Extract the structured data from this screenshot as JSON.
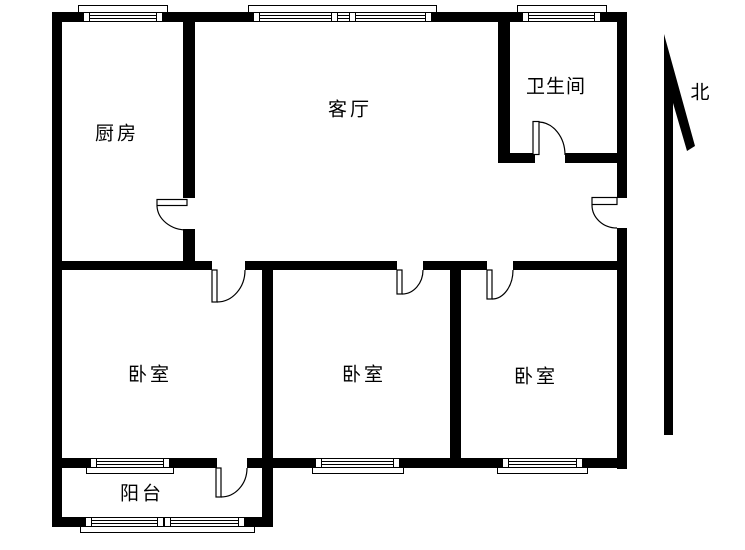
{
  "title": "apartment-floor-plan",
  "colors": {
    "wall": "#000000",
    "background": "#ffffff",
    "line": "#000000"
  },
  "floor_plan": {
    "rooms": [
      {
        "id": "kitchen",
        "label": "厨房"
      },
      {
        "id": "living-room",
        "label": "客厅"
      },
      {
        "id": "bathroom",
        "label": "卫生间"
      },
      {
        "id": "bedroom-left",
        "label": "卧室"
      },
      {
        "id": "bedroom-middle",
        "label": "卧室"
      },
      {
        "id": "bedroom-right",
        "label": "卧室"
      },
      {
        "id": "balcony",
        "label": "阳台"
      }
    ],
    "compass": {
      "label": "北",
      "direction": "north"
    },
    "counts": {
      "doors": 7,
      "windows": 7
    }
  }
}
